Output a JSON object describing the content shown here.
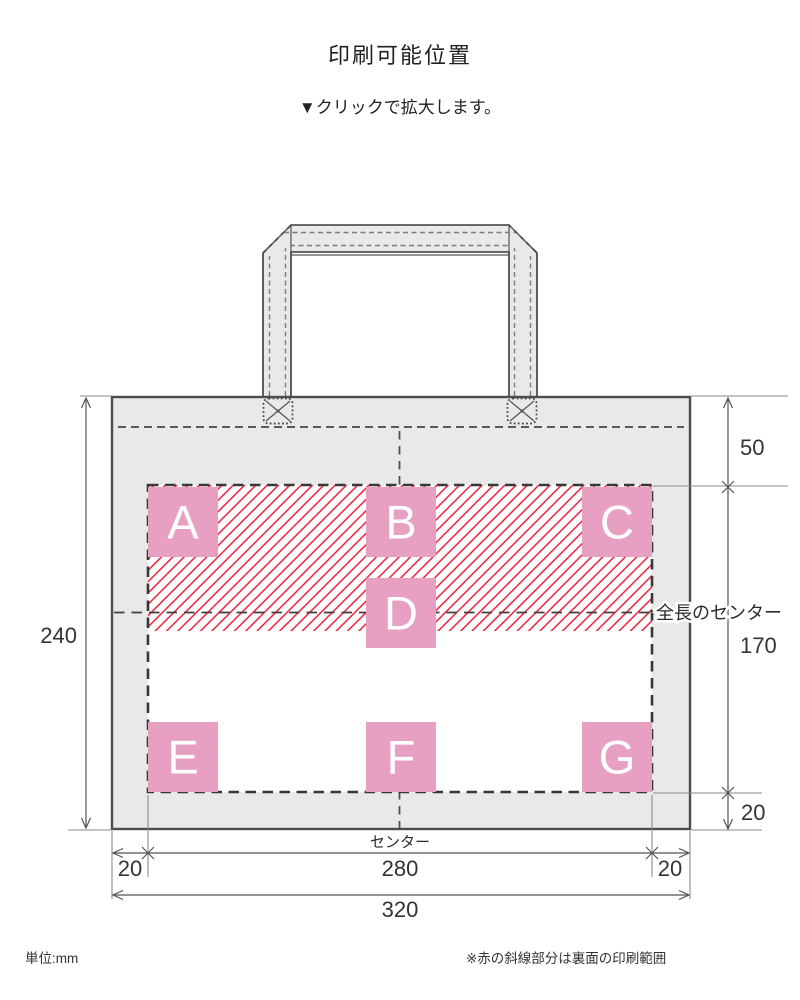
{
  "header": {
    "title": "印刷可能位置",
    "subtitle": "▼クリックで拡大します。"
  },
  "footer": {
    "unit_note": "単位:mm",
    "hatch_note": "※赤の斜線部分は裏面の印刷範囲"
  },
  "labels": {
    "full_length_center": "全長のセンター",
    "center": "センター"
  },
  "dimensions": {
    "bag_height": "240",
    "top_to_print_area": "50",
    "center_to_print_bottom": "170",
    "print_bottom_margin": "20",
    "left_margin": "20",
    "print_width": "280",
    "right_margin": "20",
    "bag_width": "320"
  },
  "positions": [
    {
      "label": "A"
    },
    {
      "label": "B"
    },
    {
      "label": "C"
    },
    {
      "label": "D"
    },
    {
      "label": "E"
    },
    {
      "label": "F"
    },
    {
      "label": "G"
    }
  ],
  "colors": {
    "position_pink": "#e8a0c2",
    "hatch_red": "#e8102c",
    "bag_gray": "#e9e9e9"
  }
}
